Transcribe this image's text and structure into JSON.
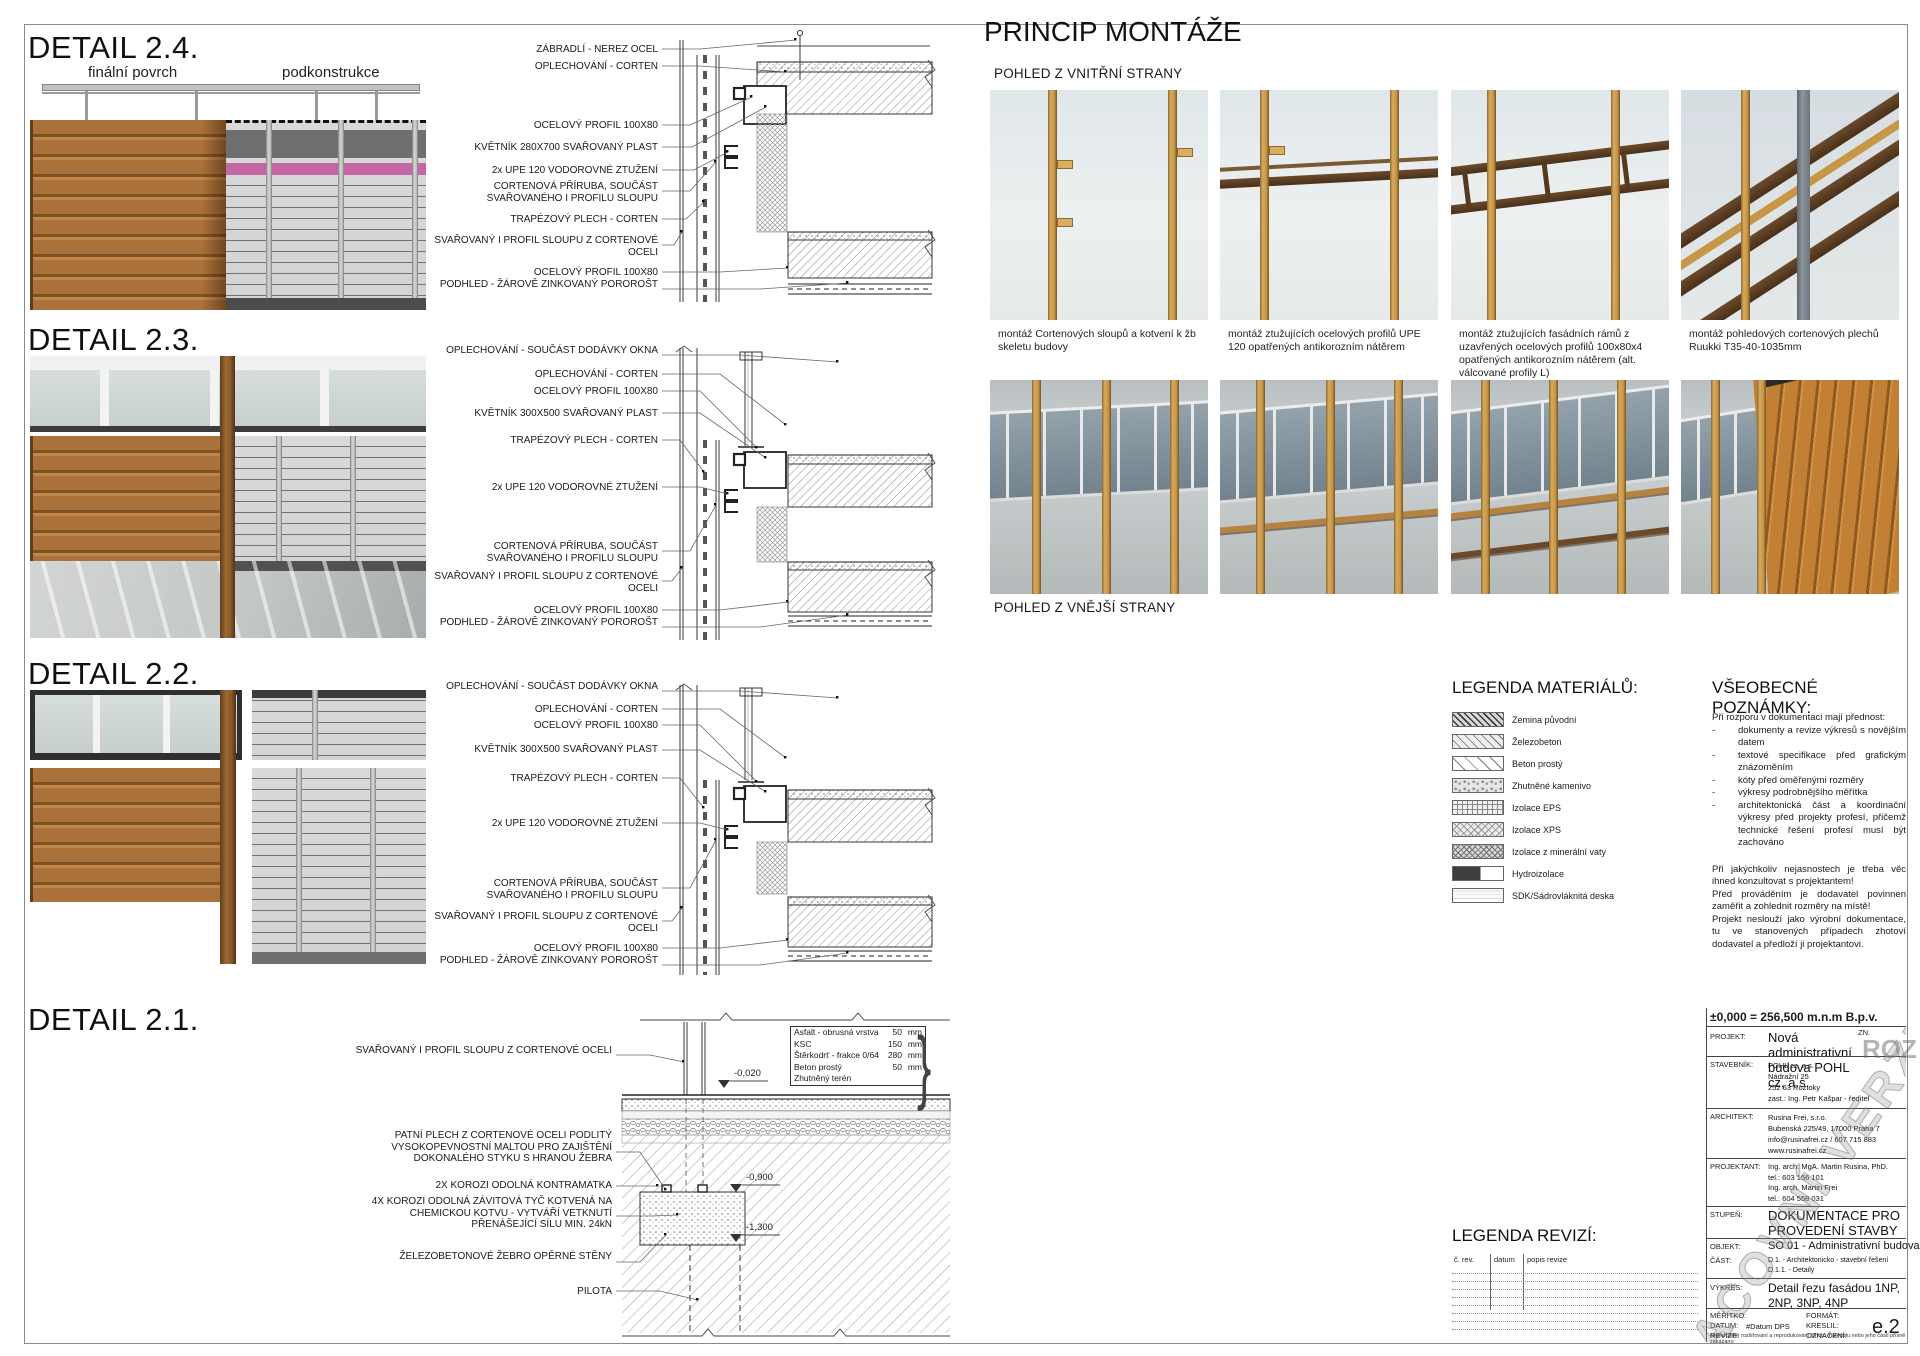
{
  "details": [
    {
      "title": "DETAIL 2.4.",
      "sub_left": "finální povrch",
      "sub_right": "podkonstrukce",
      "labels": [
        "ZÁBRADLÍ - NEREZ OCEL",
        "OPLECHOVÁNÍ - CORTEN",
        "OCELOVÝ PROFIL 100X80",
        "KVĚTNÍK 280X700 SVAŘOVANÝ PLAST",
        "2x UPE 120 VODOROVNÉ ZTUŽENÍ",
        "CORTENOVÁ PŘÍRUBA, SOUČÁST SVAŘOVANÉHO I PROFILU SLOUPU",
        "TRAPÉZOVÝ PLECH - CORTEN",
        "SVAŘOVANÝ I PROFIL SLOUPU Z CORTENOVÉ OCELI",
        "OCELOVÝ PROFIL 100X80",
        "PODHLED - ŽÁROVĚ ZINKOVANÝ POROROŠT"
      ]
    },
    {
      "title": "DETAIL 2.3.",
      "labels": [
        "OPLECHOVÁNÍ - SOUČÁST DODÁVKY OKNA",
        "OPLECHOVÁNÍ - CORTEN",
        "OCELOVÝ PROFIL 100X80",
        "KVĚTNÍK 300X500 SVAŘOVANÝ PLAST",
        "TRAPÉZOVÝ PLECH - CORTEN",
        "2x UPE 120 VODOROVNÉ ZTUŽENÍ",
        "CORTENOVÁ PŘÍRUBA, SOUČÁST SVAŘOVANÉHO I PROFILU SLOUPU",
        "SVAŘOVANÝ I PROFIL SLOUPU Z CORTENOVÉ OCELI",
        "OCELOVÝ PROFIL 100X80",
        "PODHLED - ŽÁROVĚ ZINKOVANÝ POROROŠT"
      ]
    },
    {
      "title": "DETAIL 2.2.",
      "labels": [
        "OPLECHOVÁNÍ - SOUČÁST DODÁVKY OKNA",
        "OPLECHOVÁNÍ - CORTEN",
        "OCELOVÝ PROFIL 100X80",
        "KVĚTNÍK 300X500 SVAŘOVANÝ PLAST",
        "TRAPÉZOVÝ PLECH - CORTEN",
        "2x UPE 120 VODOROVNÉ ZTUŽENÍ",
        "CORTENOVÁ PŘÍRUBA, SOUČÁST SVAŘOVANÉHO I PROFILU SLOUPU",
        "SVAŘOVANÝ I PROFIL SLOUPU Z CORTENOVÉ OCELI",
        "OCELOVÝ PROFIL 100X80",
        "PODHLED - ŽÁROVĚ ZINKOVANÝ POROROŠT"
      ]
    },
    {
      "title": "DETAIL 2.1.",
      "labels": [
        "SVAŘOVANÝ I PROFIL SLOUPU Z CORTENOVÉ OCELI",
        "PATNÍ PLECH Z CORTENOVÉ OCELI PODLITÝ VYSOKOPEVNOSTNÍ MALTOU PRO ZAJIŠTĚNÍ DOKONALÉHO STYKU S HRANOU ŽEBRA",
        "2X KOROZI ODOLNÁ  KONTRAMATKA",
        "4X KOROZI ODOLNÁ ZÁVITOVÁ TYČ KOTVENÁ NA CHEMICKOU KOTVU - VYTVÁŘÍ VETKNUTÍ PŘENÁŠEJÍCÍ SÍLU MIN. 24kN",
        "ŽELEZOBETONOVÉ ŽEBRO OPĚRNÉ STĚNY",
        "PILOTA"
      ],
      "elevations": [
        "-0,020",
        "-0,900",
        "-1,300"
      ],
      "layers": [
        {
          "name": "Asfalt - obrusná vrstva",
          "value": "50",
          "unit": "mm"
        },
        {
          "name": "KSC",
          "value": "150",
          "unit": "mm"
        },
        {
          "name": "Štěrkodrť - frakce 0/64",
          "value": "280",
          "unit": "mm"
        },
        {
          "name": "Beton prostý",
          "value": "50",
          "unit": "mm"
        },
        {
          "name": "Zhutněný terén",
          "value": "",
          "unit": ""
        }
      ]
    }
  ],
  "princip": {
    "title": "PRINCIP MONTÁŽE",
    "view1": "POHLED Z VNITŘNÍ STRANY",
    "view2": "POHLED Z VNĚJŠÍ STRANY",
    "captions": [
      "montáž Cortenových sloupů a kotvení k žb skeletu budovy",
      "montáž ztužujících ocelových profilů UPE 120 opatřených antikorozním nátěrem",
      "montáž ztužujících fasádních rámů z uzavřených ocelových profilů 100x80x4 opatřených antikorozním nátěrem (alt. válcované profily L)",
      "montáž pohledových cortenových plechů Ruukki T35-40-1035mm"
    ]
  },
  "legend": {
    "title": "LEGENDA MATERIÁLŮ:",
    "items": [
      {
        "label": "Zemina původní"
      },
      {
        "label": "Železobeton"
      },
      {
        "label": "Beton prostý"
      },
      {
        "label": "Zhutněné kamenivo"
      },
      {
        "label": "Izolace EPS"
      },
      {
        "label": "Izolace XPS"
      },
      {
        "label": "Izolace z minerální vaty"
      },
      {
        "label": "Hydroizolace"
      },
      {
        "label": "SDK/Sádrovláknitá deska"
      }
    ]
  },
  "notes": {
    "title": "VŠEOBECNÉ POZNÁMKY:",
    "intro": "Při rozporu v dokumentaci mají přednost:",
    "bullets": [
      {
        "m": "-",
        "t": "dokumenty a revize výkresů s novějším datem"
      },
      {
        "m": "-",
        "t": "textové specifikace před grafickým znázorněním"
      },
      {
        "m": "-",
        "t": "kóty před oměřenými rozměry"
      },
      {
        "m": "-",
        "t": "výkresy podrobnějšího měřítka"
      },
      {
        "m": "-",
        "t": "architektonická část a koordinační výkresy před projekty profesí, přičemž technické řešení profesí musí být zachováno"
      }
    ],
    "paragraphs": [
      "Při jakýchkoliv nejasnostech je třeba věc ihned konzultovat s projektantem!",
      "Před prováděním je dodavatel povinnen zaměřit a zohlednit rozměry na místě!",
      "Projekt neslouží jako výrobní dokumentace, tu ve stanovených případech zhotoví dodavatel a předloží ji projektantovi."
    ]
  },
  "revisions": {
    "title": "LEGENDA REVIZÍ:",
    "cols": [
      "č. rev.",
      "datum",
      "popis revize"
    ]
  },
  "titleblock": {
    "elevation_line": "±0,000 = 256,500 m.n.m B.p.v.",
    "zn_label": "ZN.",
    "project_label": "PROJEKT:",
    "project_value": "Nová administrativní budova POHL cz, a.s.",
    "stavebnik_label": "STAVEBNÍK:",
    "stavebnik_lines": [
      "POHL cz, a.s.",
      "Nádražní 25",
      "252 63 Roztoky",
      "zast.: Ing. Petr Kašpar - ředitel"
    ],
    "architekt_label": "ARCHITEKT:",
    "architekt_lines": [
      "Rusina Frei, s.r.o.",
      "Bubenská 225/49, 17000 Praha 7",
      "info@rusinafrei.cz / 607 715 883",
      "www.rusinafrei.cz"
    ],
    "projektant_label": "PROJEKTANT:",
    "projektant_lines": [
      "Ing. arch. MgA. Martin Rusina, PhD.",
      "tel.: 603 156 101",
      "Ing. arch. Martin Frei",
      "tel.: 604 558 031"
    ],
    "stupen_label": "STUPEŇ:",
    "stupen_value": "DOKUMENTACE PRO PROVEDENÍ STAVBY",
    "objekt_label": "OBJEKT:",
    "objekt_value": "SO 01 - Administrativní budova",
    "cast_label": "ČÁST:",
    "cast_lines": [
      "D.1. - Architektonicko - stavební řešení",
      "D.1.1. - Detaily"
    ],
    "vykres_label": "VÝKRES:",
    "vykres_value": "Detail řezu fasádou 1NP, 2NP, 3NP, 4NP",
    "meritko_label": "MĚŘÍTKO:",
    "format_label": "FORMÁT:",
    "datum_label": "DATUM:",
    "datum_value": "#Datum DPS",
    "kreslil_label": "KRESLIL:",
    "revize_label": "REVIZE:",
    "oznaceni_label": "OZNAČENÍ:",
    "oznaceni_value": "e.2",
    "fine_print": "Nepovolené rozšiřování a reprodukování tohoto materiálu nebo jeho části přísně zakázáno"
  },
  "watermark": {
    "text": "PRACOVNÍ VERZE",
    "stamp": "ROZ"
  }
}
